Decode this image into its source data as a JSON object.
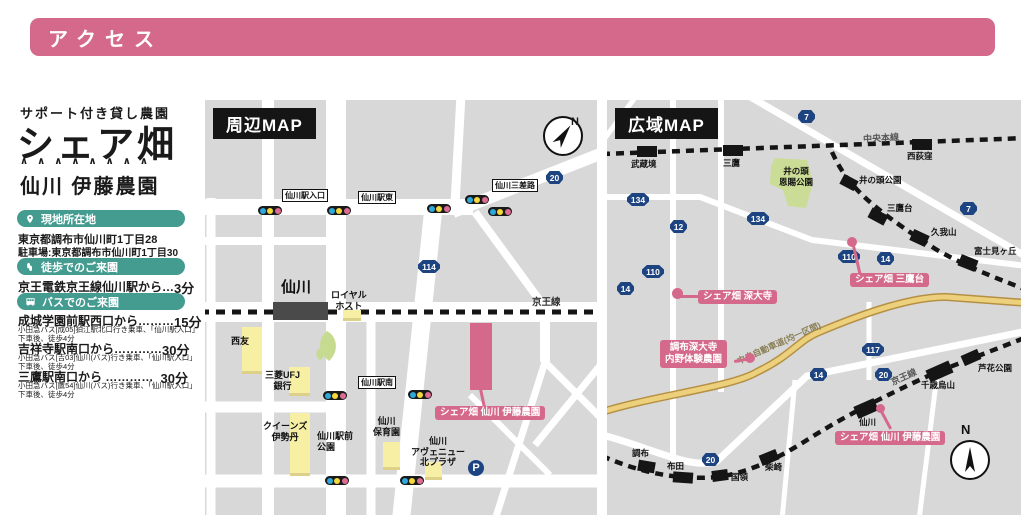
{
  "page": {
    "header_title": "アクセス"
  },
  "sidebar": {
    "tagline": "サポート付き貸し農園",
    "logo": "シェア畑",
    "carets": "∧∧∧∧∧∧∧∧",
    "farm_name": "仙川 伊藤農園",
    "location_badge": "現地所在地",
    "address": "東京都調布市仙川町1丁目28",
    "parking_address": "駐車場:東京都調布市仙川町1丁目30",
    "walk_badge": "徒歩でのご来園",
    "walk": {
      "label": "京王電鉄京王線仙川駅から…",
      "time": "3分"
    },
    "bus_badge": "バスでのご来園",
    "bus": [
      {
        "from": "成城学園前駅西口から………",
        "time": "15分",
        "note": "小田急バス[成05]狛江駅北口行き乗車、「仙川駅入口」\n下車後、徒歩4分"
      },
      {
        "from": "吉祥寺駅南口から…………",
        "time": "30分",
        "note": "小田急バス[吉03]仙川(バス)行き乗車、「仙川駅入口」\n下車後、徒歩4分"
      },
      {
        "from": "三鷹駅南口から …………",
        "time": "30分",
        "note": "小田急バス[鷹54]仙川(バス)行き乗車、「仙川駅入口」\n下車後、徒歩4分"
      }
    ]
  },
  "local_map": {
    "title": "周辺MAP",
    "north": "N",
    "station": "仙川",
    "rail_label": "京王線",
    "route_20": "20",
    "route_114": "114",
    "parking_mark": "P",
    "signals": [
      "仙川駅入口",
      "仙川駅東",
      "仙川三差路",
      "仙川駅南"
    ],
    "buildings": [
      "西友",
      "ロイヤル\nホスト",
      "三菱UFJ\n銀行",
      "クイーンズ\n伊勢丹",
      "仙川駅前\n公園",
      "仙川\n保育園",
      "仙川\nアヴェニュー\n北プラザ"
    ],
    "farm_label": "シェア畑 仙川 伊藤農園"
  },
  "wide_map": {
    "title": "広域MAP",
    "north": "N",
    "rail_chuo": "中央本線",
    "rail_keio": "京王線",
    "expressway": "中央自動車道(均一区間)",
    "park": "井の頭\n恩賜公園",
    "stations_chuo": [
      "武蔵境",
      "三鷹",
      "西荻窪"
    ],
    "stations_inokashira": [
      "井の頭公園",
      "三鷹台",
      "久我山",
      "富士見ヶ丘"
    ],
    "stations_keio": [
      "調布",
      "布田",
      "国領",
      "柴崎",
      "仙川",
      "千歳烏山",
      "芦花公園"
    ],
    "shields": [
      "7",
      "134",
      "12",
      "134",
      "7",
      "110",
      "14",
      "110",
      "14",
      "117",
      "14",
      "20",
      "20"
    ],
    "farms": [
      "シェア畑 三鷹台",
      "シェア畑 深大寺",
      "調布深大寺\n内野体験農園",
      "シェア畑 仙川 伊藤農園"
    ]
  },
  "colors": {
    "accent_pink": "#d5698c",
    "badge_teal": "#449b90",
    "route_navy": "#1d4480",
    "building_yellow": "#f6efa4",
    "park_green": "#cbdc96",
    "map_gray": "#d8d8d8"
  }
}
